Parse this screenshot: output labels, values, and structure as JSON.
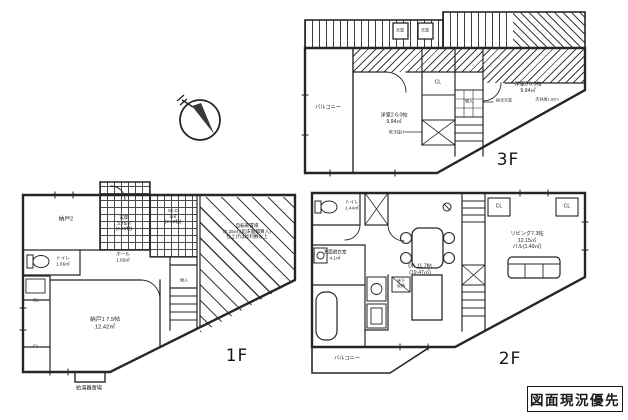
{
  "colors": {
    "ink": "#262626",
    "paper": "#ffffff"
  },
  "stamp": "図面現況優先",
  "floors": {
    "f1": {
      "name": "1F",
      "nando2": "納戸2",
      "genkan": "玄関\n3.75㎡\n(2.26帖)",
      "sic": "S.I.C\n4㎡\n(2.42帖)",
      "toilet": "トイレ\n1.66㎡",
      "hall": "ホール\n1.65㎡",
      "nando1": "納戸1 7.5帖\n12.42㎡",
      "monoire": "物入",
      "cl1": "CL",
      "cl2": "CL",
      "bicycle": "自転車置場\n(7.25㎡)(延床面積算入)\n仕上げは砂利敷以上",
      "boiler": "給湯器置場"
    },
    "f2": {
      "name": "2F",
      "toilet": "トイレ\n1.44㎡",
      "senmen": "洗面脱衣室\n4.1㎡",
      "dk": "DK 11.7帖\n(19.47㎡)",
      "yukashita": "床下\n収納",
      "living": "リビング7.3帖\n12.15㎡\nバル(1.49㎡)",
      "cl1": "CL",
      "cl2": "CL",
      "balcony": "バルコニー"
    },
    "f3": {
      "name": "3F",
      "balcony": "バルコニー",
      "room2": "洋室2 6.0帖\n9.94㎡",
      "fukinuke": "吹き抜け",
      "room3": "洋室3 6.0帖\n9.94㎡",
      "ceiling": "天井高1.82m",
      "saiko": "採光天窓",
      "skylight1": "天窓",
      "skylight2": "天窓",
      "cl": "CL",
      "monoire": "物入"
    }
  }
}
